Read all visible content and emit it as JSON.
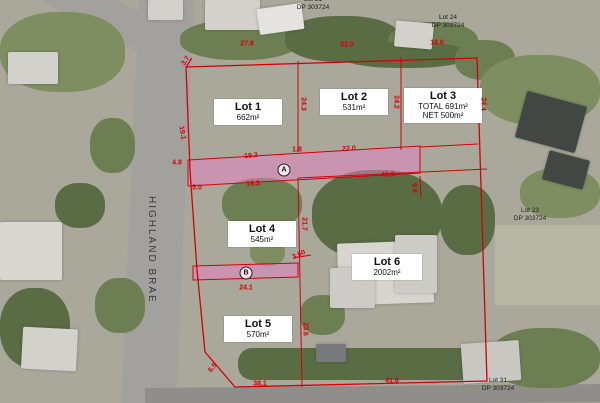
{
  "road": {
    "label": "HIGHLAND BRAE"
  },
  "lots": [
    {
      "name": "Lot 1",
      "area_lines": [
        "662m²"
      ]
    },
    {
      "name": "Lot 2",
      "area_lines": [
        "531m²"
      ]
    },
    {
      "name": "Lot 3",
      "area_lines": [
        "TOTAL 691m²",
        "NET 500m²"
      ]
    },
    {
      "name": "Lot 4",
      "area_lines": [
        "545m²"
      ]
    },
    {
      "name": "Lot 5",
      "area_lines": [
        "570m²"
      ]
    },
    {
      "name": "Lot 6",
      "area_lines": [
        "2002m²"
      ]
    }
  ],
  "adjacent_lots": [
    {
      "name": "Lot 21",
      "dp": "DP 303724"
    },
    {
      "name": "Lot 24",
      "dp": "DP 303724"
    },
    {
      "name": "Lot 23",
      "dp": "DP 303724"
    },
    {
      "name": "Lot 31",
      "dp": "DP 303724"
    }
  ],
  "easement_markers": [
    {
      "letter": "A",
      "x": 284,
      "y": 170
    },
    {
      "letter": "B",
      "x": 246,
      "y": 273
    }
  ],
  "dimensions": [
    {
      "text": "27.8",
      "x": 247,
      "y": 44,
      "rot": 0
    },
    {
      "text": "22.0",
      "x": 347,
      "y": 45,
      "rot": 0
    },
    {
      "text": "18.0",
      "x": 437,
      "y": 43,
      "rot": 0
    },
    {
      "text": "3.7",
      "x": 186,
      "y": 61,
      "rot": -55
    },
    {
      "text": "24.3",
      "x": 303,
      "y": 104,
      "rot": 90
    },
    {
      "text": "24.2",
      "x": 396,
      "y": 102,
      "rot": 90
    },
    {
      "text": "24.4",
      "x": 483,
      "y": 104,
      "rot": 90
    },
    {
      "text": "19.1",
      "x": 182,
      "y": 133,
      "rot": 80
    },
    {
      "text": "4.8",
      "x": 177,
      "y": 163,
      "rot": 0
    },
    {
      "text": "19.2",
      "x": 251,
      "y": 156,
      "rot": -4
    },
    {
      "text": "1.8",
      "x": 297,
      "y": 150,
      "rot": 0
    },
    {
      "text": "22.0",
      "x": 349,
      "y": 149,
      "rot": -3
    },
    {
      "text": "5.0",
      "x": 197,
      "y": 188,
      "rot": 0
    },
    {
      "text": "19.3",
      "x": 253,
      "y": 184,
      "rot": -3
    },
    {
      "text": "41.6",
      "x": 388,
      "y": 175,
      "rot": -3
    },
    {
      "text": "9.6",
      "x": 414,
      "y": 188,
      "rot": 85
    },
    {
      "text": "21.7",
      "x": 304,
      "y": 224,
      "rot": 90
    },
    {
      "text": "3.60",
      "x": 299,
      "y": 255,
      "rot": -25
    },
    {
      "text": "24.1",
      "x": 246,
      "y": 288,
      "rot": 0
    },
    {
      "text": "23.6",
      "x": 305,
      "y": 329,
      "rot": 90
    },
    {
      "text": "8.5",
      "x": 213,
      "y": 368,
      "rot": -52
    },
    {
      "text": "38.1",
      "x": 260,
      "y": 384,
      "rot": 0
    },
    {
      "text": "41.6",
      "x": 392,
      "y": 381,
      "rot": 0
    }
  ],
  "colors": {
    "boundary": "#d40008",
    "easement_fill": "#e87fc4",
    "lot_label_bg": "#ffffff",
    "lot_label_text": "#111111",
    "dimension_text": "#d40008",
    "adjacent_label_text": "#1c1c1c",
    "road_label_text": "#3a3a3a"
  }
}
